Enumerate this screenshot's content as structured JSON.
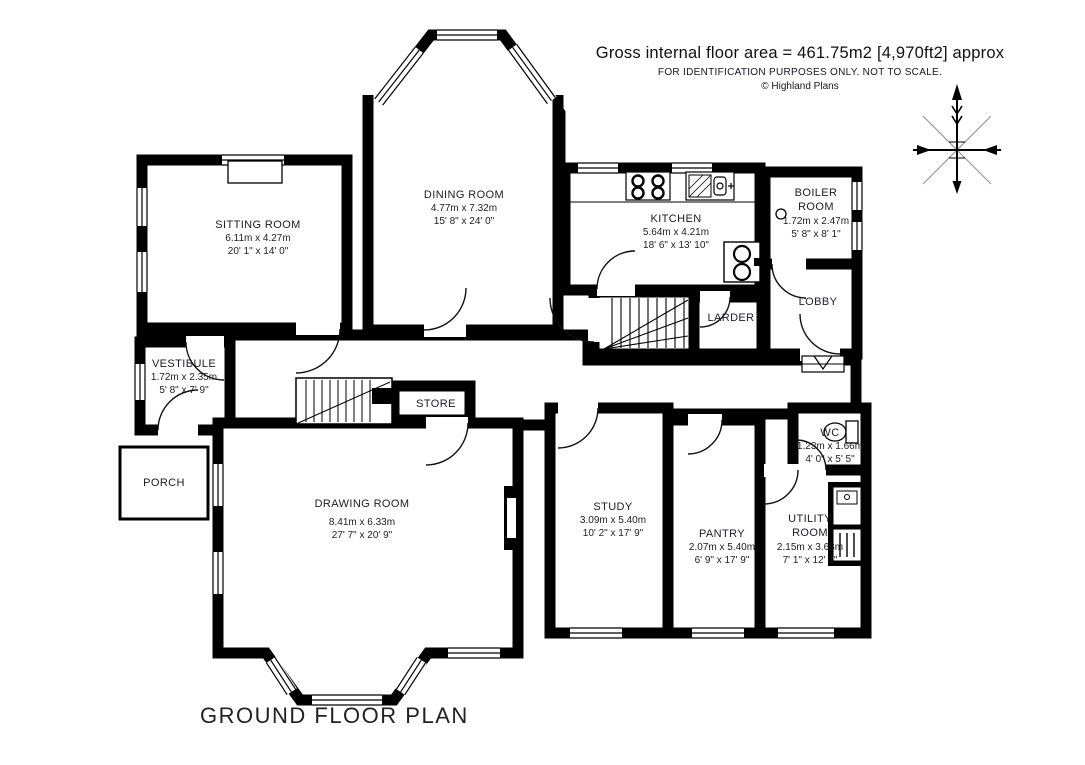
{
  "header": {
    "area_line": "Gross internal floor area = 461.75m2 [4,970ft2] approx",
    "disclaimer": "FOR IDENTIFICATION PURPOSES ONLY. NOT TO SCALE.",
    "copyright": "© Highland Plans"
  },
  "plan_title": "GROUND FLOOR PLAN",
  "rooms": [
    {
      "id": "sitting-room",
      "name": "SITTING ROOM",
      "metric": "6.11m x 4.27m",
      "imperial": "20' 1\" x 14' 0\""
    },
    {
      "id": "dining-room",
      "name": "DINING ROOM",
      "metric": "4.77m x 7.32m",
      "imperial": "15' 8\" x 24' 0\""
    },
    {
      "id": "kitchen",
      "name": "KITCHEN",
      "metric": "5.64m x 4.21m",
      "imperial": "18' 6\" x 13' 10\""
    },
    {
      "id": "boiler-room",
      "name": "BOILER ROOM",
      "metric": "1.72m x 2.47m",
      "imperial": "5' 8\" x 8' 1\""
    },
    {
      "id": "lobby",
      "name": "LOBBY"
    },
    {
      "id": "larder",
      "name": "LARDER"
    },
    {
      "id": "vestibule",
      "name": "VESTIBULE",
      "metric": "1.72m x 2.35m",
      "imperial": "5' 8\" x 7' 9\""
    },
    {
      "id": "store",
      "name": "STORE"
    },
    {
      "id": "porch",
      "name": "PORCH"
    },
    {
      "id": "drawing-room",
      "name": "DRAWING ROOM",
      "metric": "8.41m x 6.33m",
      "imperial": "27' 7\" x 20' 9\""
    },
    {
      "id": "study",
      "name": "STUDY",
      "metric": "3.09m x 5.40m",
      "imperial": "10' 2\" x 17' 9\""
    },
    {
      "id": "pantry",
      "name": "PANTRY",
      "metric": "2.07m x 5.40m",
      "imperial": "6' 9\" x 17' 9\""
    },
    {
      "id": "utility-room",
      "name": "UTILITY ROOM",
      "metric": "2.15m x 3.68m",
      "imperial": "7' 1\" x 12' 1\""
    },
    {
      "id": "wc",
      "name": "WC",
      "metric": "1.23m x 1.66m",
      "imperial": "4' 0\" x 5' 5\""
    }
  ],
  "colors": {
    "wall": "#000000",
    "background": "#ffffff",
    "label_text": "#1c1c26",
    "compass_diagonal": "#999999"
  }
}
